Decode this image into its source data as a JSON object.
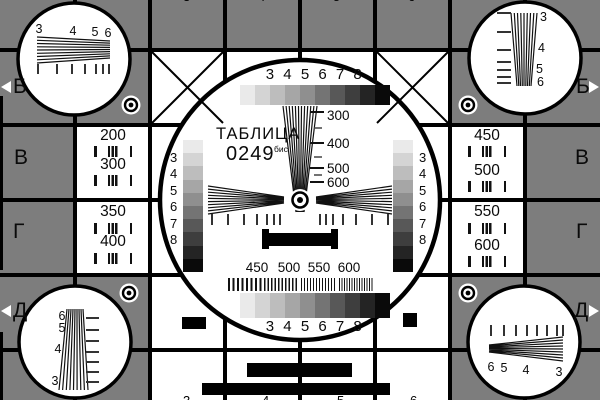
{
  "card": {
    "title": "ТАБЛИЦА",
    "number": "0249",
    "number_suffix": "бис"
  },
  "colors": {
    "background": "#7d7d7d",
    "surface": "#ffffff",
    "line": "#000000",
    "grayscale_steps": [
      "#eaeaea",
      "#d4d4d4",
      "#bdbdbd",
      "#a6a6a6",
      "#8f8f8f",
      "#747474",
      "#585858",
      "#3e3e3e",
      "#242424",
      "#0a0a0a"
    ]
  },
  "center": {
    "top_scale": "3 4 5 6 7 8",
    "bottom_scale": "3 4 5 6 7 8",
    "wedge_labels": [
      "300",
      "400",
      "500",
      "600"
    ],
    "resolution_labels": [
      "450",
      "500",
      "550",
      "600"
    ],
    "left_wedge_scale": [
      "3",
      "4",
      "5",
      "6",
      "7",
      "8"
    ],
    "right_wedge_scale": [
      "3",
      "4",
      "5",
      "6",
      "7",
      "8"
    ]
  },
  "side_panels": {
    "left": [
      "200",
      "300",
      "350",
      "400"
    ],
    "right": [
      "450",
      "500",
      "550",
      "600"
    ]
  },
  "corner_circles": {
    "top_left": [
      "3",
      "4",
      "5",
      "6"
    ],
    "top_right": [
      "3",
      "4",
      "5",
      "6"
    ],
    "bottom_left": [
      "6",
      "5",
      "4",
      "3"
    ],
    "bottom_right": [
      "6",
      "5",
      "4",
      "3"
    ]
  },
  "edge_letters": {
    "left": [
      "Б",
      "В",
      "Г",
      "Д"
    ],
    "right": [
      "Б",
      "В",
      "Г",
      "Д"
    ]
  },
  "border_digits": {
    "top": [
      "3",
      "4",
      "5",
      "6"
    ],
    "bottom": [
      "3",
      "4",
      "5",
      "6"
    ]
  }
}
